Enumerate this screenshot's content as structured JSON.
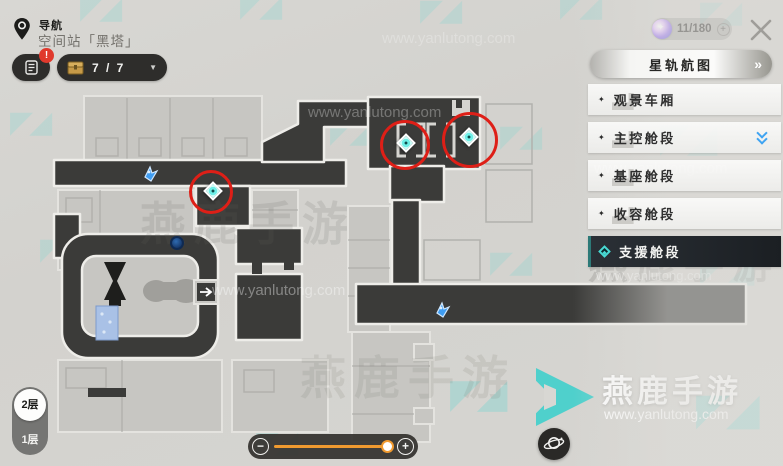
{
  "header": {
    "nav_label": "导航",
    "location_name": "空间站「黑塔」",
    "guide_badge": "!",
    "chest_progress": "7 / 7",
    "currency_value": "11/180"
  },
  "icons": {
    "dropdown_arrow": "▼",
    "double_chevron_right": "»",
    "plus": "+",
    "minus": "−",
    "sparkle": "✦"
  },
  "sidebar": {
    "title": "星轨航图",
    "items": [
      {
        "label": "观景车厢"
      },
      {
        "label": "主控舱段"
      },
      {
        "label": "基座舱段"
      },
      {
        "label": "收容舱段"
      },
      {
        "label": "支援舱段"
      }
    ],
    "selected_index": 4
  },
  "floor_selector": {
    "floors": [
      {
        "label": "2层"
      },
      {
        "label": "1层"
      }
    ],
    "selected_index": 0
  },
  "zoom_control": {
    "value_pct": 84
  },
  "map": {
    "teleport_marker_count": 3,
    "highlight_circle_count": 3
  },
  "colors": {
    "accent_teal": "#4fd8d2",
    "highlight_red": "#de1f17",
    "slider_orange": "#f09a30",
    "position_blue": "#3fa4f2",
    "corridor_dark": "#3b3b39"
  },
  "watermark": {
    "brand": "燕鹿手游",
    "url": "www.yanlutong.com"
  }
}
